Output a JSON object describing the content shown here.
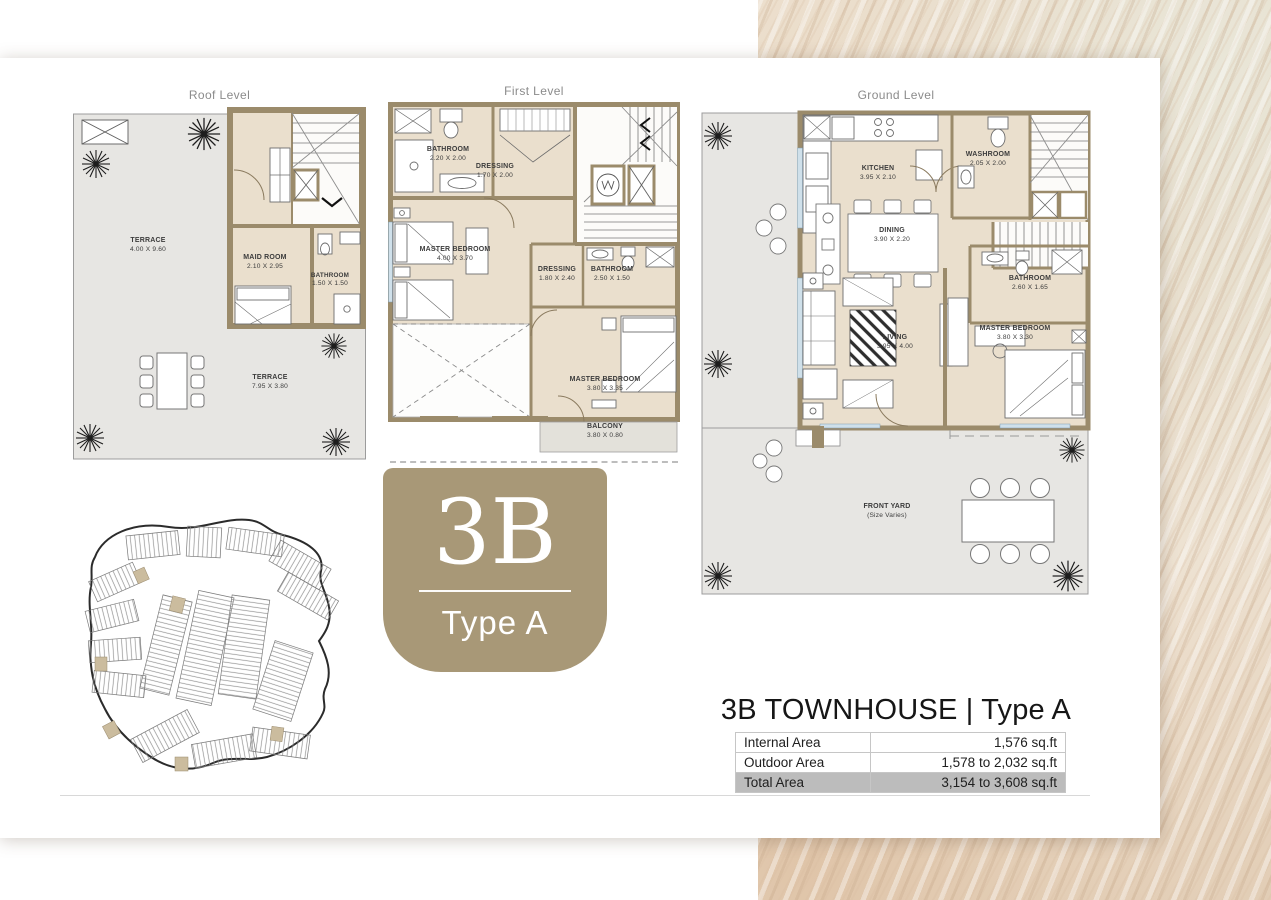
{
  "document": {
    "headline": "3B TOWNHOUSE | Type A",
    "badge": {
      "unit": "3B",
      "type": "Type A"
    },
    "plans": {
      "roof": {
        "title": "Roof Level",
        "rooms": [
          {
            "name": "TERRACE",
            "dims": "4.00 X 9.60"
          },
          {
            "name": "MAID ROOM",
            "dims": "2.10 X 2.95"
          },
          {
            "name": "BATHROOM",
            "dims": "1.50 X 1.50"
          },
          {
            "name": "TERRACE",
            "dims": "7.95 X 3.80"
          }
        ]
      },
      "first": {
        "title": "First Level",
        "rooms": [
          {
            "name": "BATHROOM",
            "dims": "2.20 X 2.00"
          },
          {
            "name": "DRESSING",
            "dims": "1.70 X 2.00"
          },
          {
            "name": "MASTER BEDROOM",
            "dims": "4.00 X 3.70"
          },
          {
            "name": "DRESSING",
            "dims": "1.80 X 2.40"
          },
          {
            "name": "BATHROOM",
            "dims": "2.50 X 1.50"
          },
          {
            "name": "MASTER BEDROOM",
            "dims": "3.80 X 3.35"
          },
          {
            "name": "BALCONY",
            "dims": "3.80 X 0.80"
          }
        ]
      },
      "ground": {
        "title": "Ground Level",
        "rooms": [
          {
            "name": "KITCHEN",
            "dims": "3.95 X 2.10"
          },
          {
            "name": "WASHROOM",
            "dims": "2.05 X 2.00"
          },
          {
            "name": "DINING",
            "dims": "3.90 X 2.20"
          },
          {
            "name": "BATHROOM",
            "dims": "2.60 X 1.65"
          },
          {
            "name": "LIVING",
            "dims": "3.95 X 4.00"
          },
          {
            "name": "MASTER BEDROOM",
            "dims": "3.80 X 3.30"
          },
          {
            "name": "FRONT YARD",
            "dims": "(Size Varies)"
          }
        ]
      }
    },
    "area_table": {
      "rows": [
        {
          "label": "Internal Area",
          "value": "1,576 sq.ft"
        },
        {
          "label": "Outdoor Area",
          "value": "1,578 to 2,032 sq.ft"
        },
        {
          "label": "Total Area",
          "value": "3,154 to 3,608 sq.ft"
        }
      ]
    },
    "colors": {
      "accent": "#a89877",
      "wall": "#9b8b6b",
      "total_row": "#bcbcbc"
    }
  }
}
